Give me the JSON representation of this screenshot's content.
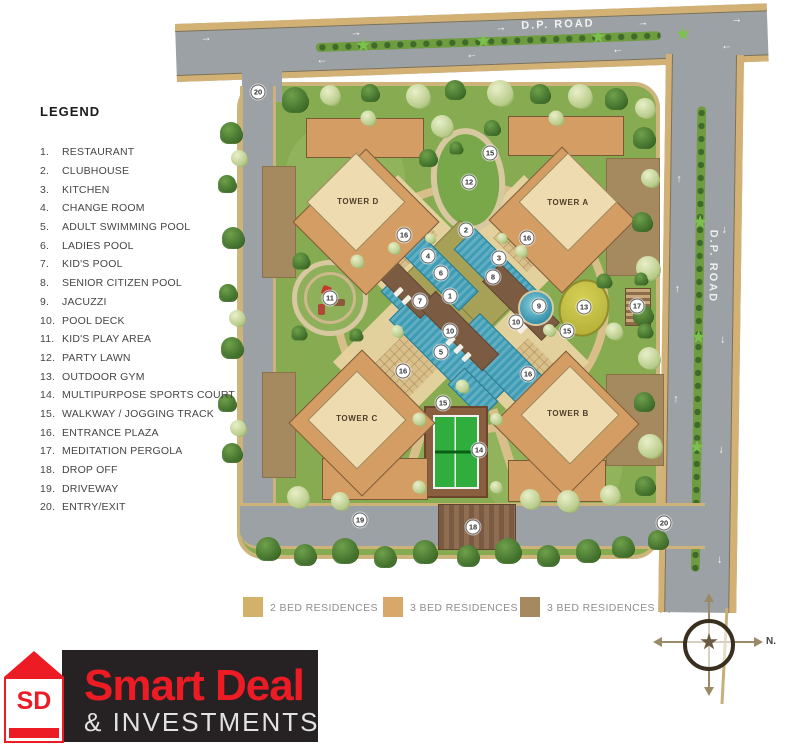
{
  "legend": {
    "title": "LEGEND",
    "items": [
      {
        "num": "1.",
        "label": "RESTAURANT"
      },
      {
        "num": "2.",
        "label": "CLUBHOUSE"
      },
      {
        "num": "3.",
        "label": "KITCHEN"
      },
      {
        "num": "4.",
        "label": "CHANGE ROOM"
      },
      {
        "num": "5.",
        "label": "ADULT SWIMMING POOL"
      },
      {
        "num": "6.",
        "label": "LADIES POOL"
      },
      {
        "num": "7.",
        "label": "KID'S POOL"
      },
      {
        "num": "8.",
        "label": "SENIOR CITIZEN POOL"
      },
      {
        "num": "9.",
        "label": "JACUZZI"
      },
      {
        "num": "10.",
        "label": "POOL DECK"
      },
      {
        "num": "11.",
        "label": "KID'S PLAY AREA"
      },
      {
        "num": "12.",
        "label": "PARTY LAWN"
      },
      {
        "num": "13.",
        "label": "OUTDOOR GYM"
      },
      {
        "num": "14.",
        "label": "MULTIPURPOSE SPORTS COURT"
      },
      {
        "num": "15.",
        "label": "WALKWAY / JOGGING TRACK"
      },
      {
        "num": "16.",
        "label": "ENTRANCE PLAZA"
      },
      {
        "num": "17.",
        "label": "MEDITATION PERGOLA"
      },
      {
        "num": "18.",
        "label": "DROP OFF"
      },
      {
        "num": "19.",
        "label": "DRIVEWAY"
      },
      {
        "num": "20.",
        "label": "ENTRY/EXIT"
      }
    ]
  },
  "roads": {
    "top": {
      "label": "D.P. ROAD"
    },
    "right": {
      "label": "D.P. ROAD"
    }
  },
  "site": {
    "towers": [
      {
        "id": "tower-d",
        "label": "TOWER D"
      },
      {
        "id": "tower-a",
        "label": "TOWER A"
      },
      {
        "id": "tower-c",
        "label": "TOWER C"
      },
      {
        "id": "tower-b",
        "label": "TOWER B"
      }
    ],
    "markers": [
      {
        "n": "1",
        "x": 450,
        "y": 296
      },
      {
        "n": "2",
        "x": 466,
        "y": 230
      },
      {
        "n": "3",
        "x": 499,
        "y": 258
      },
      {
        "n": "4",
        "x": 428,
        "y": 256
      },
      {
        "n": "5",
        "x": 441,
        "y": 352
      },
      {
        "n": "6",
        "x": 441,
        "y": 273
      },
      {
        "n": "7",
        "x": 420,
        "y": 301
      },
      {
        "n": "8",
        "x": 493,
        "y": 277
      },
      {
        "n": "9",
        "x": 539,
        "y": 306
      },
      {
        "n": "10",
        "x": 450,
        "y": 331
      },
      {
        "n": "10",
        "x": 516,
        "y": 322
      },
      {
        "n": "11",
        "x": 330,
        "y": 298
      },
      {
        "n": "12",
        "x": 469,
        "y": 182
      },
      {
        "n": "13",
        "x": 584,
        "y": 307
      },
      {
        "n": "14",
        "x": 479,
        "y": 450
      },
      {
        "n": "15",
        "x": 490,
        "y": 153
      },
      {
        "n": "15",
        "x": 567,
        "y": 331
      },
      {
        "n": "15",
        "x": 443,
        "y": 403
      },
      {
        "n": "16",
        "x": 404,
        "y": 235
      },
      {
        "n": "16",
        "x": 527,
        "y": 238
      },
      {
        "n": "16",
        "x": 403,
        "y": 371
      },
      {
        "n": "16",
        "x": 528,
        "y": 374
      },
      {
        "n": "17",
        "x": 637,
        "y": 306
      },
      {
        "n": "18",
        "x": 473,
        "y": 527
      },
      {
        "n": "19",
        "x": 360,
        "y": 520
      },
      {
        "n": "20",
        "x": 258,
        "y": 92
      },
      {
        "n": "20",
        "x": 664,
        "y": 523
      }
    ]
  },
  "residence_legend": [
    {
      "label": "2 BED RESIDENCES",
      "color": "#d2b269"
    },
    {
      "label": "3 BED RESIDENCES",
      "color": "#d8a76a"
    },
    {
      "label": "3 BED RESIDENCES (L)",
      "color": "#a5895f"
    }
  ],
  "compass": {
    "north_label": "N."
  },
  "logo": {
    "monogram": "SD",
    "title": "Smart Deal",
    "subtitle": "& INVESTMENTS"
  },
  "colors": {
    "road": "#9ba1a5",
    "road_edge": "#d3b175",
    "median_green": "#6f9c3f",
    "site_green": "#86ab51",
    "track_tan": "#d8bf8a",
    "tower_orange": "#d49d63",
    "tower_core": "#eedbb0",
    "brown_l": "#a5895f",
    "pool": "#3e9cb4",
    "deck_brown": "#7b5c43",
    "lawn_olive": "#a7a158",
    "tennis_green": "#2fae3e",
    "logo_red": "#ed1c24",
    "logo_black": "#262224"
  }
}
